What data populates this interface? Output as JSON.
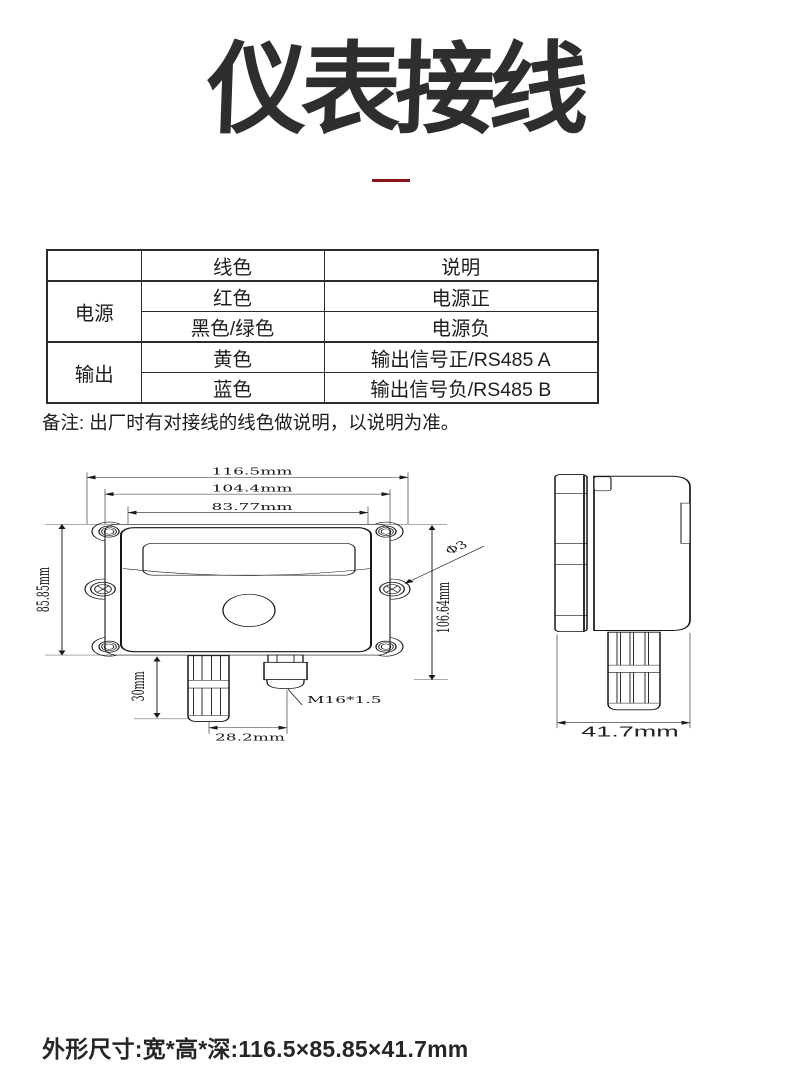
{
  "page": {
    "title": "仪表接线",
    "note": "备注: 出厂时有对接线的线色做说明，以说明为准。",
    "footer": "外形尺寸:宽*高*深:116.5×85.85×41.7mm",
    "accent_color": "#8a1418",
    "ink_color": "#2e2e2e"
  },
  "wiring_table": {
    "headers": {
      "group": "",
      "color": "线色",
      "desc": "说明"
    },
    "groups": [
      {
        "label": "电源",
        "rows": [
          {
            "color": "红色",
            "desc": "电源正"
          },
          {
            "color": "黑色/绿色",
            "desc": "电源负"
          }
        ]
      },
      {
        "label": "输出",
        "rows": [
          {
            "color": "黄色",
            "desc": "输出信号正/RS485 A"
          },
          {
            "color": "蓝色",
            "desc": "输出信号负/RS485 B"
          }
        ]
      }
    ]
  },
  "drawing": {
    "front": {
      "width_overall": "116.5mm",
      "width_body": "104.4mm",
      "width_window": "83.77mm",
      "height_body": "85.85mm",
      "height_overall": "106.64mm",
      "probe_length": "30mm",
      "probe_spacing": "28.2mm",
      "gland_thread": "M16*1.5",
      "hole_diameter": "Φ3"
    },
    "side": {
      "depth": "41.7mm"
    }
  }
}
